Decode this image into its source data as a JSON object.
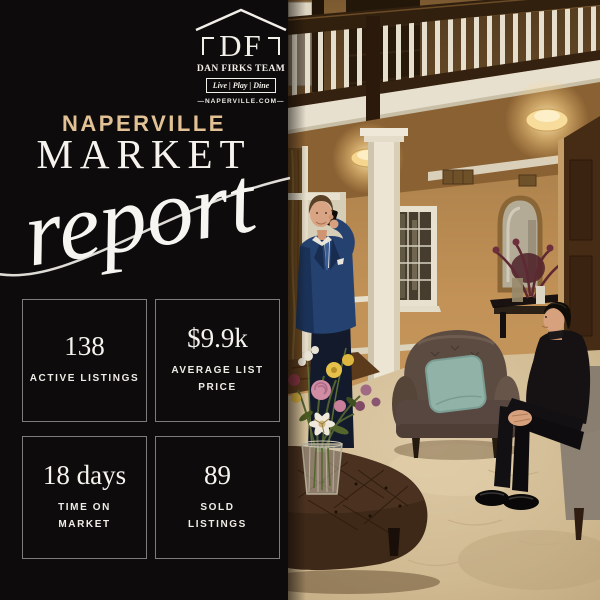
{
  "brand": {
    "monogram": "DF",
    "team_name": "DAN FIRKS TEAM",
    "tagline": "Live | Play | Dine",
    "website": "—NAPERVILLE.COM—"
  },
  "title": {
    "location": "NAPERVILLE",
    "headline": "MARKET",
    "script_word": "report"
  },
  "stats": [
    {
      "value": "138",
      "label": "ACTIVE LISTINGS"
    },
    {
      "value": "$9.9k",
      "label": "AVERAGE LIST\nPRICE"
    },
    {
      "value": "18 days",
      "label": "TIME ON\nMARKET"
    },
    {
      "value": "89",
      "label": "SOLD\nLISTINGS"
    }
  ],
  "photo": {
    "alt": "Two real estate agents in a luxury home foyer: one standing in a navy suit talking on a phone beside a white column and a flower bouquet, one seated in black near a tufted armchair, with a balcony railing and warm ceiling lights above."
  },
  "colors": {
    "background": "#0d0b0c",
    "accent_gold": "#e2c294",
    "text_white": "#f6f3ee",
    "box_border": "#7d7d7d"
  }
}
